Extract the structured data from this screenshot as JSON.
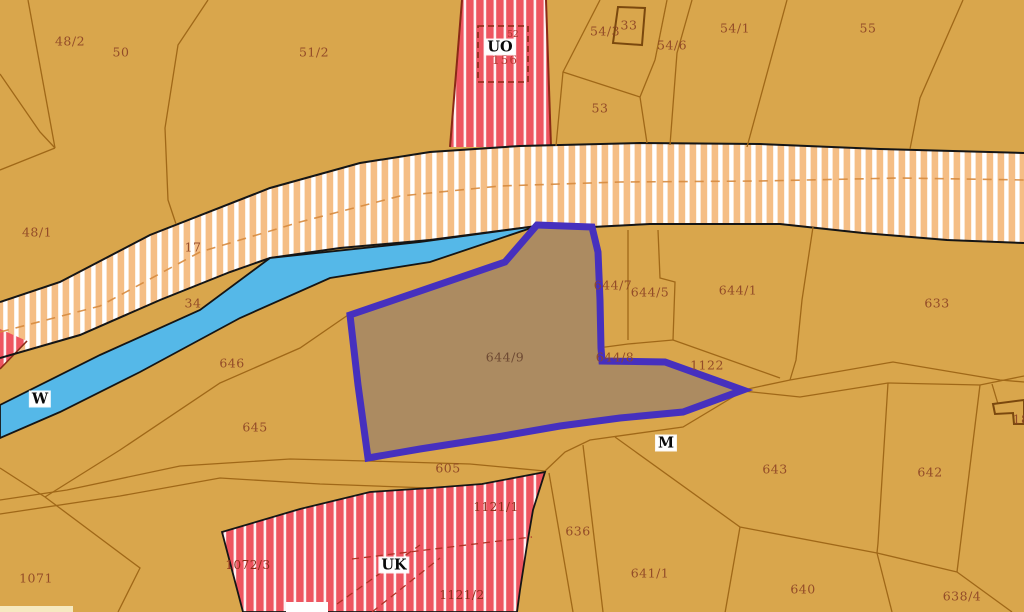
{
  "map": {
    "selected_parcel": {
      "id": "644/9"
    },
    "colors": {
      "background": "#D9A64C",
      "parcel_line": "#A06818",
      "building_line": "#7A480E",
      "road_band_fill": "#F5BE85",
      "road_band_stripe": "#FFFFFF",
      "road_band_dash": "#D68A3E",
      "red_zone_fill": "#EE5560",
      "red_zone_stripe": "#FFFFFF",
      "red_zone_edge": "#8A2A16",
      "water_fill": "#55B8E8",
      "outline_black": "#151515",
      "selection_fill": "#AC8B61",
      "selection_border": "#4630BE",
      "label_color": "#8E4526",
      "label_red": "#8C2C1A",
      "label_crimson": "#B43A34"
    },
    "labels": [
      {
        "text": "48/2",
        "x": 70,
        "y": 41,
        "kind": "parcel"
      },
      {
        "text": "50",
        "x": 121,
        "y": 52,
        "kind": "parcel"
      },
      {
        "text": "51/2",
        "x": 314,
        "y": 52,
        "kind": "parcel"
      },
      {
        "text": "54/3",
        "x": 605,
        "y": 31,
        "kind": "parcel"
      },
      {
        "text": "33",
        "x": 629,
        "y": 25,
        "kind": "parcel"
      },
      {
        "text": "54/6",
        "x": 672,
        "y": 45,
        "kind": "parcel"
      },
      {
        "text": "54/1",
        "x": 735,
        "y": 28,
        "kind": "parcel"
      },
      {
        "text": "55",
        "x": 868,
        "y": 28,
        "kind": "parcel"
      },
      {
        "text": "53",
        "x": 600,
        "y": 108,
        "kind": "parcel"
      },
      {
        "text": "48/1",
        "x": 37,
        "y": 232,
        "kind": "parcel"
      },
      {
        "text": "17",
        "x": 193,
        "y": 247,
        "kind": "parcel"
      },
      {
        "text": "34",
        "x": 193,
        "y": 303,
        "kind": "parcel"
      },
      {
        "text": "646",
        "x": 232,
        "y": 363,
        "kind": "parcel"
      },
      {
        "text": "645",
        "x": 255,
        "y": 427,
        "kind": "parcel"
      },
      {
        "text": "644/7",
        "x": 613,
        "y": 285,
        "kind": "parcel"
      },
      {
        "text": "644/5",
        "x": 650,
        "y": 292,
        "kind": "parcel"
      },
      {
        "text": "644/1",
        "x": 738,
        "y": 290,
        "kind": "parcel"
      },
      {
        "text": "633",
        "x": 937,
        "y": 303,
        "kind": "parcel"
      },
      {
        "text": "644/9",
        "x": 505,
        "y": 357,
        "kind": "parcel-dark"
      },
      {
        "text": "644/8",
        "x": 615,
        "y": 357,
        "kind": "parcel"
      },
      {
        "text": "1122",
        "x": 707,
        "y": 365,
        "kind": "parcel"
      },
      {
        "text": "605",
        "x": 448,
        "y": 468,
        "kind": "parcel"
      },
      {
        "text": "643",
        "x": 775,
        "y": 469,
        "kind": "parcel"
      },
      {
        "text": "642",
        "x": 930,
        "y": 472,
        "kind": "parcel"
      },
      {
        "text": "636",
        "x": 578,
        "y": 531,
        "kind": "parcel"
      },
      {
        "text": "641/1",
        "x": 650,
        "y": 573,
        "kind": "parcel"
      },
      {
        "text": "640",
        "x": 803,
        "y": 589,
        "kind": "parcel"
      },
      {
        "text": "638/4",
        "x": 962,
        "y": 596,
        "kind": "parcel"
      },
      {
        "text": "1071",
        "x": 36,
        "y": 578,
        "kind": "parcel"
      },
      {
        "text": "18",
        "x": 1021,
        "y": 419,
        "kind": "parcel"
      },
      {
        "text": "156",
        "x": 505,
        "y": 60,
        "kind": "crimson"
      },
      {
        "text": "52",
        "x": 513,
        "y": 35,
        "kind": "red-small"
      },
      {
        "text": "1072/3",
        "x": 248,
        "y": 565,
        "kind": "red"
      },
      {
        "text": "1121/1",
        "x": 496,
        "y": 507,
        "kind": "red"
      },
      {
        "text": "1121/2",
        "x": 462,
        "y": 595,
        "kind": "red"
      },
      {
        "text": "UO",
        "x": 500,
        "y": 47,
        "kind": "marker"
      },
      {
        "text": "W",
        "x": 40,
        "y": 399,
        "kind": "marker"
      },
      {
        "text": "M",
        "x": 666,
        "y": 443,
        "kind": "marker"
      },
      {
        "text": "UK",
        "x": 394,
        "y": 565,
        "kind": "marker"
      }
    ]
  }
}
